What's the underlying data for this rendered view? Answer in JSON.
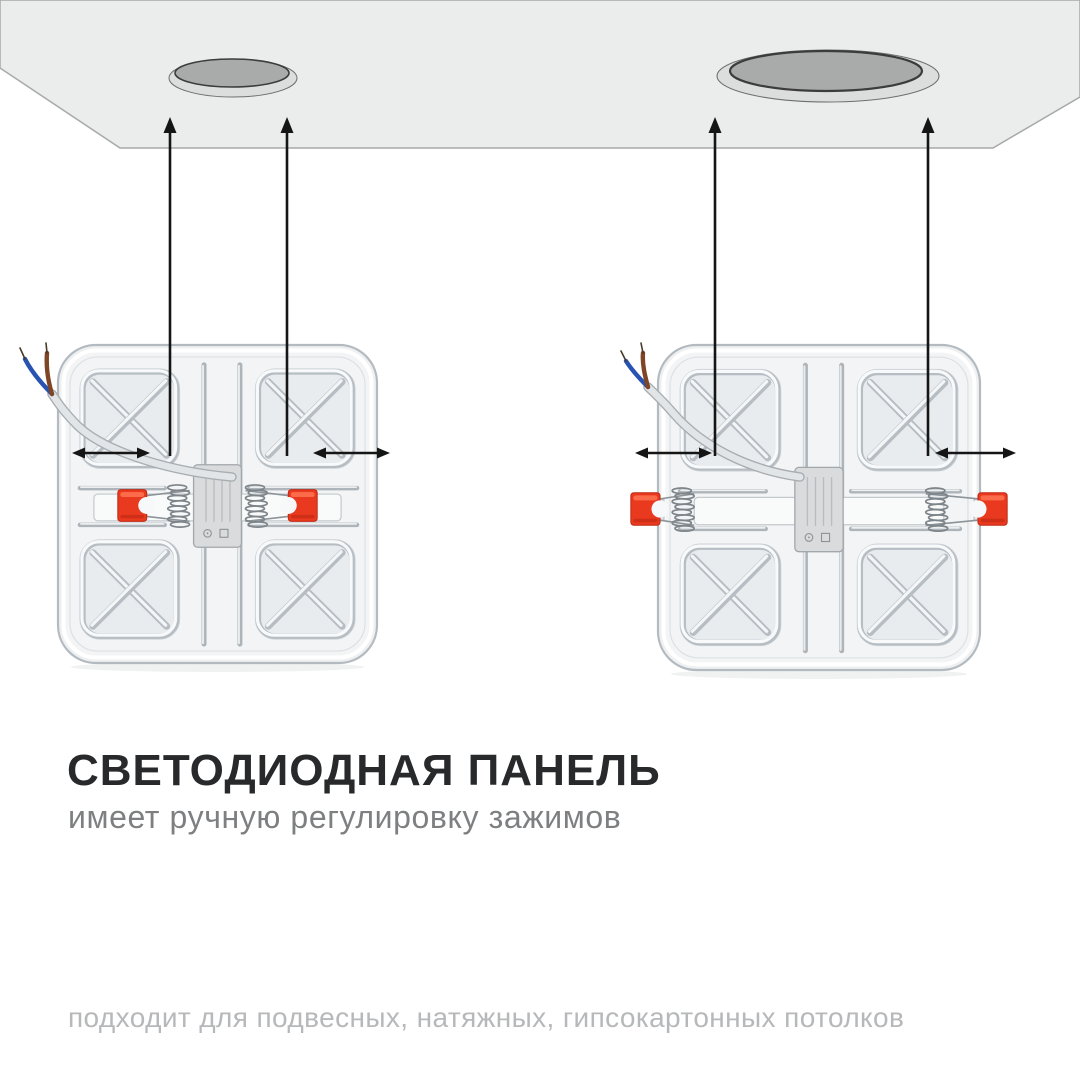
{
  "heading": {
    "title": "СВЕТОДИОДНАЯ ПАНЕЛЬ",
    "subtitle": "имеет ручную регулировку зажимов"
  },
  "footer": {
    "text": "подходит для подвесных, натяжных, гипсокартонных потолков"
  },
  "colors": {
    "background": "#ffffff",
    "ceiling_fill": "#ebecec",
    "ceiling_edge": "#a6a9aa",
    "hole_rim": "#dcdddd",
    "hole_inner": "#a9aaaa",
    "hole_outline": "#3c3c3c",
    "panel_face": "#f3f4f5",
    "panel_edge": "#b3bac0",
    "rib_shadow": "#b6bdc3",
    "rib_highlight": "#f7f9fa",
    "clamp_red": "#e9391f",
    "clamp_red_dark": "#bf2a12",
    "clamp_red_light": "#ff7553",
    "spring_metal": "#7d848a",
    "driver_box": "#d9dbdd",
    "wire_cable": "#e2e5e7",
    "wire_blue": "#2853b0",
    "wire_brown": "#7e4526",
    "arrow": "#151515",
    "title_text": "#28292b",
    "subtitle_text": "#7d7f81",
    "footer_text": "#b6b8ba"
  },
  "diagram": {
    "description": "LED panel backs with adjustable spring clamps pointing up to two round ceiling cutout holes",
    "ceiling": {
      "holes": [
        "small-round-cutout",
        "large-round-cutout"
      ]
    },
    "panels": [
      {
        "name": "led-panel-left",
        "clamp_state": "retracted"
      },
      {
        "name": "led-panel-right",
        "clamp_state": "extended"
      }
    ]
  }
}
